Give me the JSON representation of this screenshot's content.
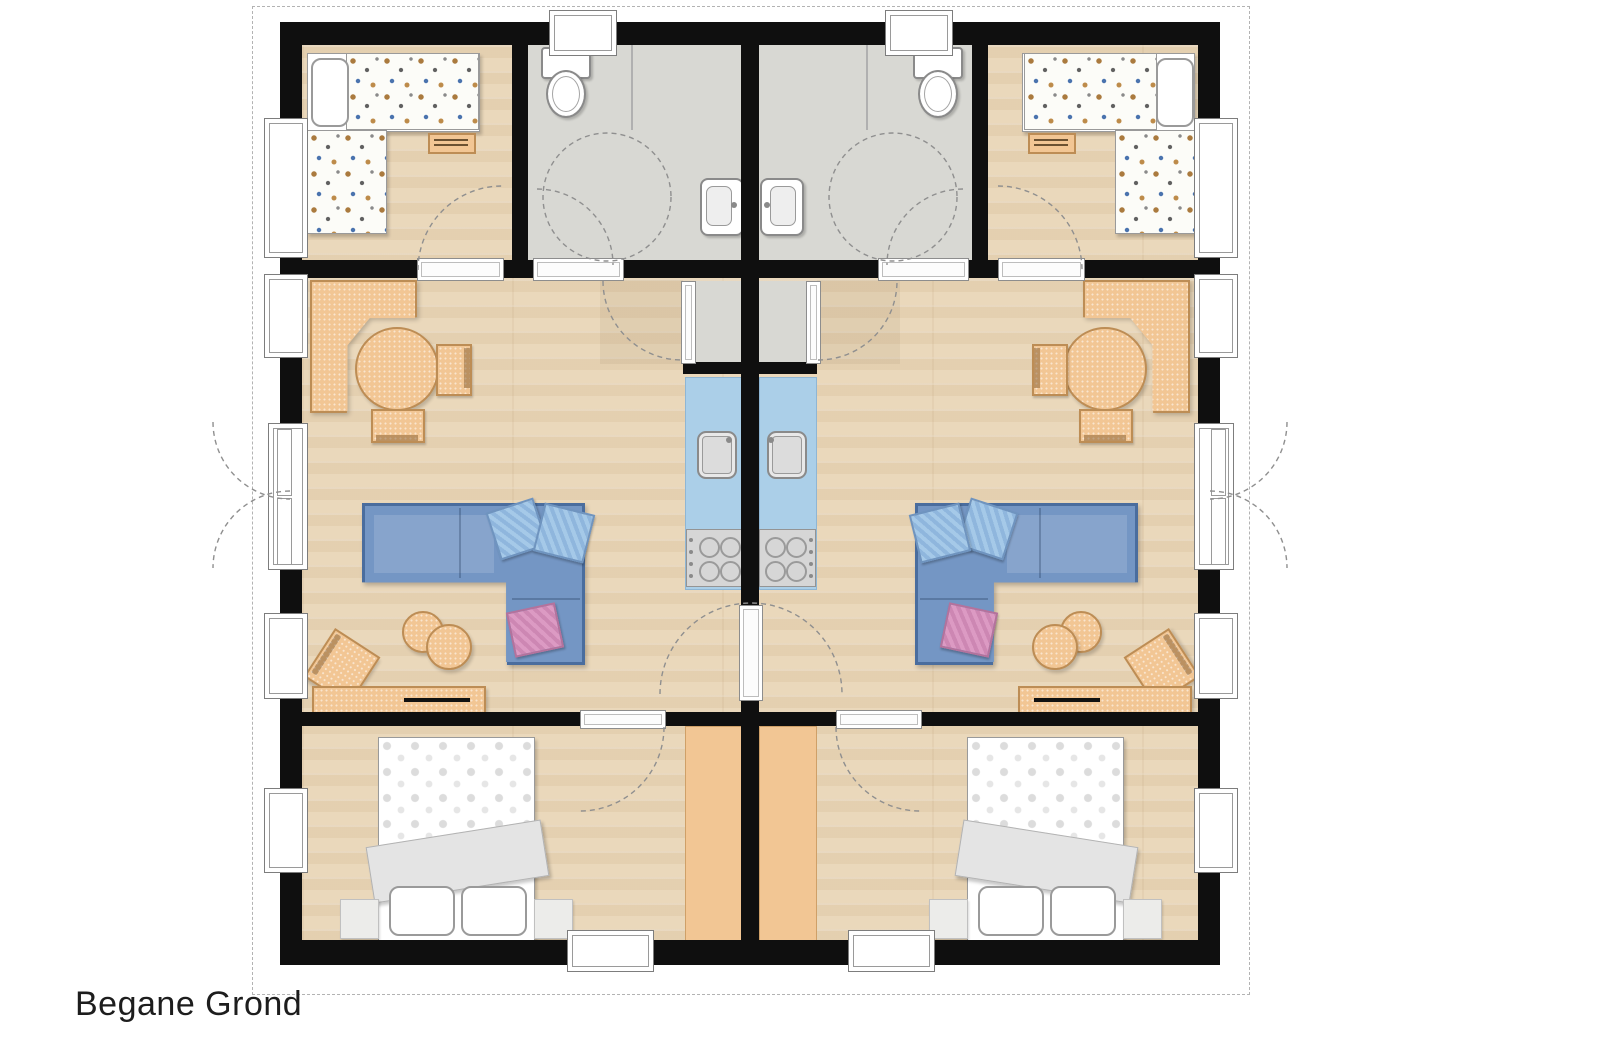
{
  "title": {
    "label": "Begane Grond"
  },
  "colors": {
    "wall": "#0f0f0f",
    "wood_floor": "#ead8bb",
    "tile_floor": "#d8d8d3",
    "furniture_wood": "#f2c694",
    "furniture_wood_border": "#bd8d55",
    "sofa_fill": "#7496c4",
    "sofa_border": "#4a6d9e",
    "pillow_blue": "#a5c9e8",
    "pillow_pink": "#dc9ac3",
    "kitchen_counter": "#abcfe8",
    "appliance_gray": "#d6d6d6",
    "bed_white": "#ffffff",
    "blanket_gray": "#e4e4e4",
    "line_gray": "#9a9a9a",
    "boundary_dash": "#b3b3b3",
    "pattern_brown": "#aa7a3e",
    "pattern_blue": "#4a73ae"
  }
}
